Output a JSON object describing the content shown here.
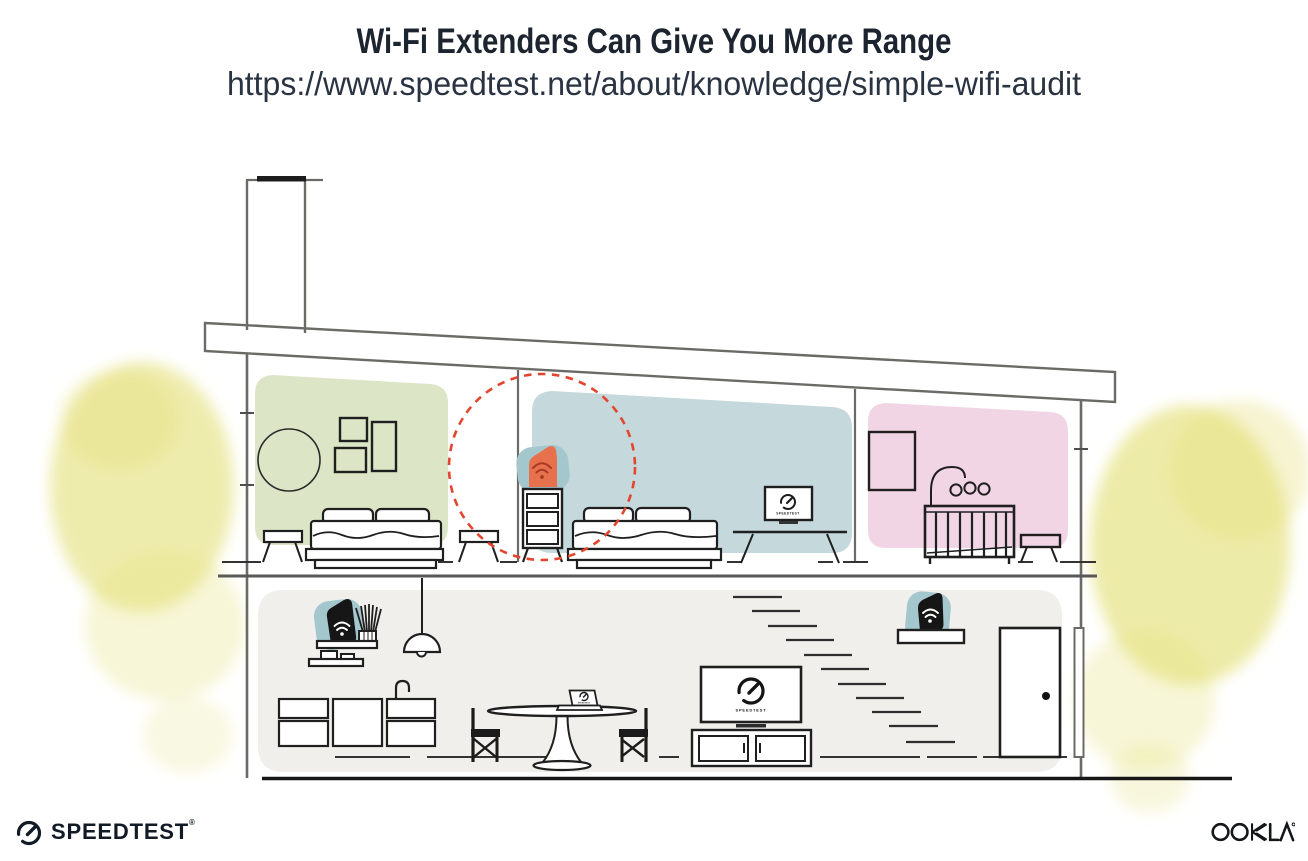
{
  "header": {
    "title": "Wi-Fi Extenders Can Give You More Range",
    "url": "https://www.speedtest.net/about/knowledge/simple-wifi-audit"
  },
  "devices": {
    "bedroom_tv_label": "SPEEDTEST",
    "living_tv_label": "SPEEDTEST",
    "laptop_label": "SPEEDTEST"
  },
  "footer": {
    "speedtest_wordmark": "SPEEDTEST",
    "speedtest_registered": "®",
    "ookla_wordmark": "OOKLA"
  },
  "colors": {
    "title-text": "#1c2430",
    "url-text": "#2a3342",
    "line-dark": "#1f1f1f",
    "line-gray": "#6a6a66",
    "room-green": "#dde5c7",
    "room-blue": "#c5d8db",
    "room-pink": "#f1d5e5",
    "room-gray": "#f0efec",
    "extender-orange": "#e8714d",
    "extender-wifi-red": "#a63a25",
    "device-black": "#161616",
    "halo-teal": "#a4c7ce",
    "range-red": "#e2462f",
    "foliage-yellow": "#e4e07a",
    "logo-dark": "#121a26"
  }
}
